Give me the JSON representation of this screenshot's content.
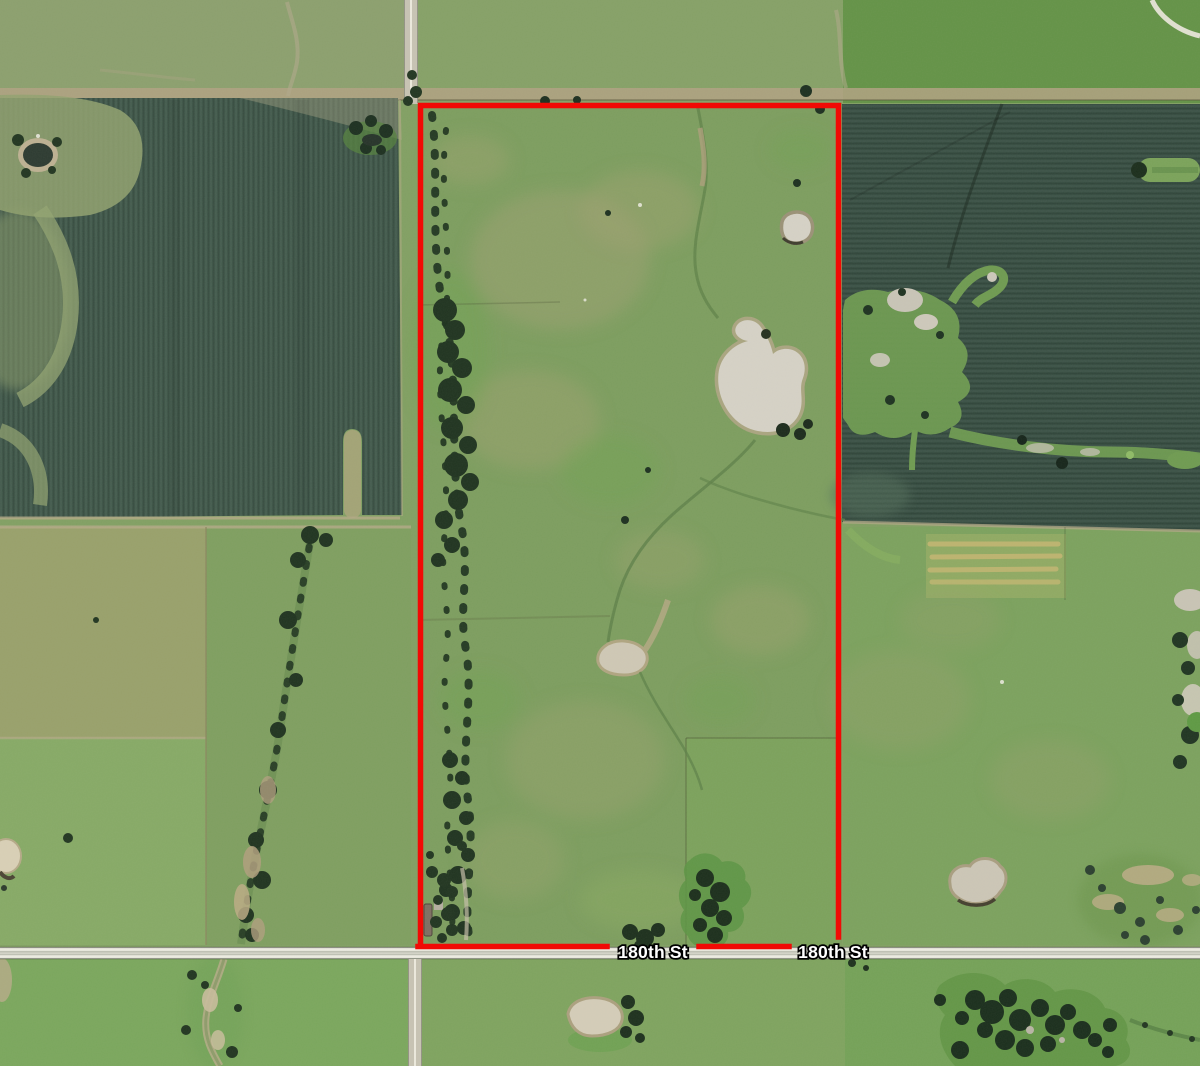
{
  "map": {
    "description": "Aerial satellite view of rural farmland parcels with a red outlined property boundary along 180th St",
    "road_labels": [
      {
        "text": "180th St",
        "x": 653,
        "y": 958
      },
      {
        "text": "180th St",
        "x": 833,
        "y": 958
      }
    ],
    "boundary": {
      "color": "#f10a05",
      "stroke_width": 5.5
    },
    "label_style": {
      "fill": "#ffffff",
      "outline": "#000000"
    },
    "palette": {
      "pasture": "#82a063",
      "pasture_top_left": "#8ca06e",
      "pasture_top_mid": "#86a167",
      "pasture_top_right": "#649347",
      "pasture_olive_field": "#99a16b",
      "pasture_lower_left": "#87aa66",
      "pasture_scrub": "#7f9f60",
      "pasture_lower_right": "#7ca25e",
      "pasture_below_road_left": "#7ba75d",
      "pasture_below_road_mid": "#7fa45f",
      "pasture_below_road_right": "#75a258",
      "property_pasture": "#7d9e5f",
      "crop_field_left": "#3e5648",
      "crop_field_right": "#364d41",
      "field_edge_tan": "#b2a283",
      "trees_dark": "#203420",
      "pond_tan": "#d6d2c6",
      "pond_dark": "#2d3b31",
      "road_gray": "#bfc1b4",
      "road_stripe": "#edece2",
      "wetland_green": "#6f9b51"
    }
  }
}
